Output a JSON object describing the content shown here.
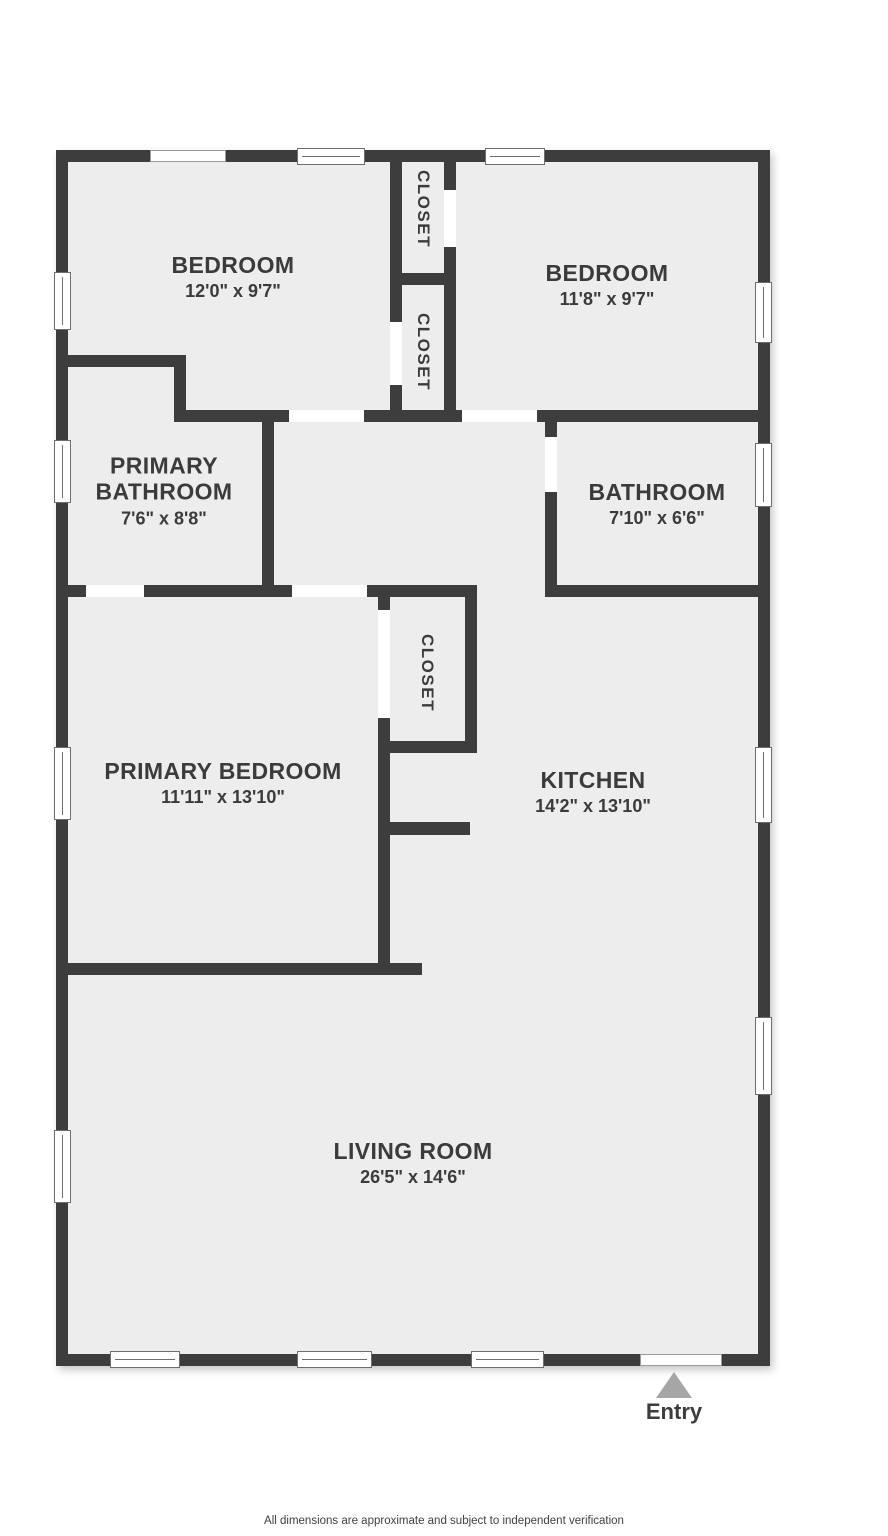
{
  "plan_title": "floor-plan",
  "colors": {
    "wall": "#3d3d3d",
    "floor": "#ededed",
    "background": "#ffffff",
    "entry_arrow": "#a6a6a6",
    "text": "#3b3b3b"
  },
  "rooms": [
    {
      "id": "bedroom-1",
      "name": "BEDROOM",
      "dims": "12'0\" x 9'7\""
    },
    {
      "id": "bedroom-2",
      "name": "BEDROOM",
      "dims": "11'8\" x 9'7\""
    },
    {
      "id": "primary-bathroom",
      "name": "PRIMARY BATHROOM",
      "dims": "7'6\" x 8'8\""
    },
    {
      "id": "bathroom",
      "name": "BATHROOM",
      "dims": "7'10\" x 6'6\""
    },
    {
      "id": "primary-bedroom",
      "name": "PRIMARY BEDROOM",
      "dims": "11'11\" x 13'10\""
    },
    {
      "id": "kitchen",
      "name": "KITCHEN",
      "dims": "14'2\" x 13'10\""
    },
    {
      "id": "living-room",
      "name": "LIVING ROOM",
      "dims": "26'5\" x 14'6\""
    }
  ],
  "closets": [
    {
      "label": "CLOSET"
    },
    {
      "label": "CLOSET"
    },
    {
      "label": "CLOSET"
    }
  ],
  "entry": {
    "label": "Entry"
  },
  "footer": {
    "disclaimer": "All dimensions are approximate and subject to independent verification"
  }
}
